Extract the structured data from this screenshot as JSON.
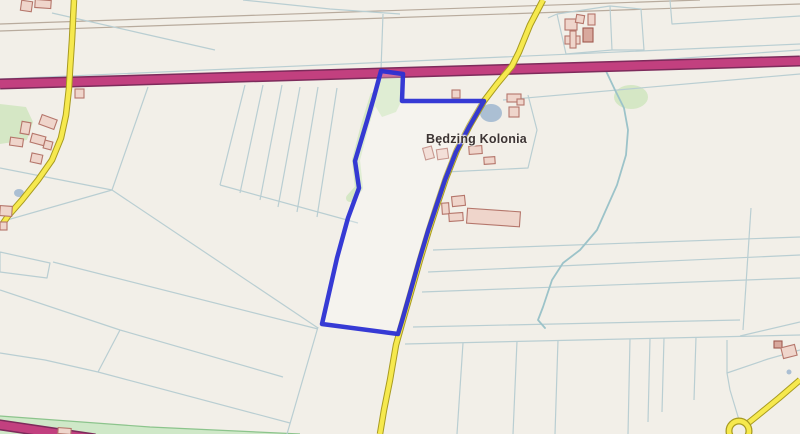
{
  "map": {
    "place_label": "Będzing Kolonia",
    "palette": {
      "background": "#f2efe8",
      "field_line": "#b9ced2",
      "path_line": "#b8ab9d",
      "motorway_fill": "#c2407f",
      "motorway_casing": "#7d2b5b",
      "road_fill": "#f6e94e",
      "road_casing": "#a89b20",
      "parcel_stroke": "#2b2fd3",
      "parcel_fill": "rgba(255,255,255,0.25)",
      "building_fill": "#efd5cb",
      "building_stroke": "#b5766b",
      "building_dark_fill": "#d8a89d",
      "building_dark_stroke": "#a05a50",
      "green_fill": "#d5e7c5",
      "green_band_fill": "#cfe8c8",
      "green_band_edge": "#8cc48c",
      "water_fill": "#abbfd3",
      "stream": "#9cc3c9"
    },
    "parcel": {
      "points": "381,71 403,74 402,101 484,101 469,127 456,152 445,180 436,207 428,231 419,261 410,293 402,321 398,334 322,324 337,258 348,218 359,188 355,161 367,121 374,97",
      "stroke_width": 4.5
    },
    "motorways": [
      {
        "points": "0,84 800,61",
        "width": 8,
        "casing_width": 11
      },
      {
        "points": "-6,424 95,439",
        "width": 8,
        "casing_width": 11
      }
    ],
    "roads": [
      {
        "id": "road-main",
        "points": "543,0 530,25 519,52 512,66 497,84 484,101 470,125 457,150 446,178 437,205 429,230 420,260 411,292 403,320 396,345 390,380 384,410 380,434",
        "width": 4.5,
        "casing_width": 6.5
      },
      {
        "id": "road-left",
        "points": "74,0 72,40 70,70 69,88 66,115 61,138 52,160 38,180 22,200 8,216 0,228",
        "width": 4.5,
        "casing_width": 6.5
      },
      {
        "id": "road-bottom-right",
        "points": "800,380 779,398 757,416 747,424",
        "width": 4.5,
        "casing_width": 6.5
      }
    ],
    "roundabout": {
      "cx": 739,
      "cy": 431,
      "r": 10
    },
    "field_lines": [
      "0,24 700,0",
      "0,31 800,4",
      "243,0 330,9 400,14",
      "52,13 140,33 215,50",
      "383,14 381,70",
      "0,79 390,62 800,44",
      "557,14 610,6 641,9 644,50 612,50 566,54 557,14",
      "610,6 612,50",
      "548,18 557,14",
      "670,0 672,24 800,16",
      "503,100 800,74",
      "513,70 800,50",
      "528,95 537,130 528,168 445,172",
      "433,250 800,237",
      "428,272 800,255",
      "422,292 800,278",
      "413,327 740,320",
      "405,344 800,335",
      "751,208 743,330",
      "463,343 457,434",
      "517,341 513,434",
      "558,340 555,434",
      "630,339 628,434",
      "650,339 648,422",
      "664,338 662,412",
      "696,337 694,400",
      "727,340 727,373 768,359 800,350",
      "739,420 730,390 727,373",
      "740,336 800,322",
      "245,85 220,185",
      "263,85 240,193",
      "282,85 260,200",
      "300,87 278,207",
      "318,87 297,212",
      "337,88 317,217",
      "220,185 358,223",
      "148,87 112,190",
      "112,190 0,222",
      "0,168 112,190",
      "112,190 318,328",
      "53,262 318,329",
      "0,252 50,263 47,278 0,272 0,252",
      "0,290 120,330 283,377",
      "120,330 98,372",
      "0,353 45,360 98,372",
      "98,372 290,423",
      "318,327 287,434"
    ],
    "greens": [
      {
        "type": "polygon",
        "points": "380,73 402,75 402,100 396,112 382,117 372,101 376,83"
      },
      {
        "type": "stroke",
        "points": "374,96 365,125 356,160 359,188 350,198",
        "width": 8
      },
      {
        "type": "ellipse",
        "cx": 631,
        "cy": 97,
        "rx": 17,
        "ry": 12
      },
      {
        "type": "polygon",
        "points": "0,104 26,107 33,122 27,140 0,144"
      },
      {
        "type": "band",
        "points": "0,416 150,427 300,434 0,434"
      }
    ],
    "waters": [
      {
        "type": "stream",
        "points": "606,71 615,90 624,108 628,130 626,155 617,185 605,212 597,230 580,250 563,263 552,280 543,307 538,320 545,328"
      },
      {
        "type": "ellipse",
        "cx": 491,
        "cy": 113,
        "rx": 11,
        "ry": 9
      },
      {
        "type": "ellipse",
        "cx": 19,
        "cy": 193,
        "rx": 5,
        "ry": 4
      },
      {
        "type": "ellipse",
        "cx": 789,
        "cy": 372,
        "rx": 2.5,
        "ry": 2.5
      }
    ],
    "buildings": [
      {
        "x": 21,
        "y": 1,
        "w": 11,
        "h": 10,
        "rot": 8
      },
      {
        "x": 35,
        "y": 0,
        "w": 16,
        "h": 8,
        "rot": 4
      },
      {
        "x": 75,
        "y": 89,
        "w": 9,
        "h": 9,
        "rot": 0
      },
      {
        "x": 40,
        "y": 117,
        "w": 16,
        "h": 10,
        "rot": 20
      },
      {
        "x": 21,
        "y": 122,
        "w": 9,
        "h": 12,
        "rot": 10
      },
      {
        "x": 31,
        "y": 135,
        "w": 14,
        "h": 9,
        "rot": 15
      },
      {
        "x": 10,
        "y": 138,
        "w": 13,
        "h": 8,
        "rot": 8
      },
      {
        "x": 44,
        "y": 141,
        "w": 8,
        "h": 8,
        "rot": 15
      },
      {
        "x": 31,
        "y": 154,
        "w": 11,
        "h": 9,
        "rot": 12
      },
      {
        "x": 0,
        "y": 206,
        "w": 12,
        "h": 10,
        "rot": 4
      },
      {
        "x": 0,
        "y": 222,
        "w": 7,
        "h": 8,
        "rot": 0
      },
      {
        "x": 58,
        "y": 428,
        "w": 13,
        "h": 6,
        "rot": 4
      },
      {
        "x": 565,
        "y": 19,
        "w": 12,
        "h": 11,
        "rot": 0
      },
      {
        "x": 576,
        "y": 15,
        "w": 8,
        "h": 8,
        "rot": 10
      },
      {
        "x": 588,
        "y": 14,
        "w": 7,
        "h": 11,
        "rot": 0
      },
      {
        "x": 583,
        "y": 28,
        "w": 10,
        "h": 14,
        "rot": 0,
        "dark": true
      },
      {
        "x": 565,
        "y": 36,
        "w": 15,
        "h": 8,
        "rot": 0
      },
      {
        "x": 570,
        "y": 31,
        "w": 6,
        "h": 17,
        "rot": 0
      },
      {
        "x": 452,
        "y": 90,
        "w": 8,
        "h": 8,
        "rot": 0
      },
      {
        "x": 507,
        "y": 94,
        "w": 14,
        "h": 8,
        "rot": 0
      },
      {
        "x": 517,
        "y": 99,
        "w": 7,
        "h": 6,
        "rot": 0
      },
      {
        "x": 509,
        "y": 107,
        "w": 10,
        "h": 10,
        "rot": 0
      },
      {
        "x": 424,
        "y": 147,
        "w": 9,
        "h": 12,
        "rot": -15
      },
      {
        "x": 437,
        "y": 149,
        "w": 11,
        "h": 10,
        "rot": -8
      },
      {
        "x": 469,
        "y": 146,
        "w": 13,
        "h": 8,
        "rot": -4
      },
      {
        "x": 484,
        "y": 157,
        "w": 11,
        "h": 7,
        "rot": -4
      },
      {
        "x": 442,
        "y": 203,
        "w": 7,
        "h": 11,
        "rot": -4
      },
      {
        "x": 452,
        "y": 196,
        "w": 13,
        "h": 10,
        "rot": -6
      },
      {
        "x": 449,
        "y": 213,
        "w": 14,
        "h": 8,
        "rot": -4
      },
      {
        "x": 467,
        "y": 210,
        "w": 53,
        "h": 15,
        "rot": 4
      },
      {
        "x": 774,
        "y": 341,
        "w": 8,
        "h": 7,
        "rot": 0,
        "dark": true
      },
      {
        "x": 782,
        "y": 346,
        "w": 14,
        "h": 11,
        "rot": -14
      }
    ],
    "label_pos": {
      "left": 426,
      "top": 132
    }
  }
}
